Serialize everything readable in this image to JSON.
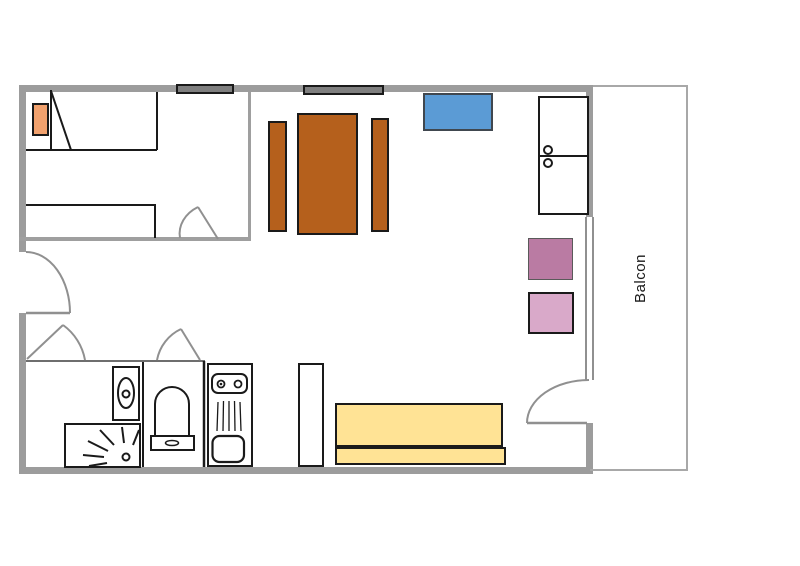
{
  "floor_plan": {
    "balcony_label": "Balcon",
    "colors": {
      "wall_gray": "#9c9c9c",
      "window_fill": "#7f7f7f",
      "door_swing_gray": "#909090",
      "outline_black": "#1a1a1a",
      "pillow_orange": "#f2a26e",
      "table_brown": "#b5601c",
      "sideboard_blue": "#5b9bd5",
      "chair_dark_pink": "#ba7ba3",
      "chair_light_pink": "#d9a9c9",
      "sofa_yellow": "#ffe395"
    },
    "furniture": [
      "double-bed",
      "pillow",
      "single-bed",
      "bench-left",
      "dining-table",
      "bench-right",
      "sideboard",
      "cabinet-two-doors",
      "chair-dark-pink",
      "chair-light-pink",
      "toilet",
      "shower",
      "washbasin",
      "kitchen-sink-unit",
      "shelf",
      "sofa-bed"
    ]
  }
}
